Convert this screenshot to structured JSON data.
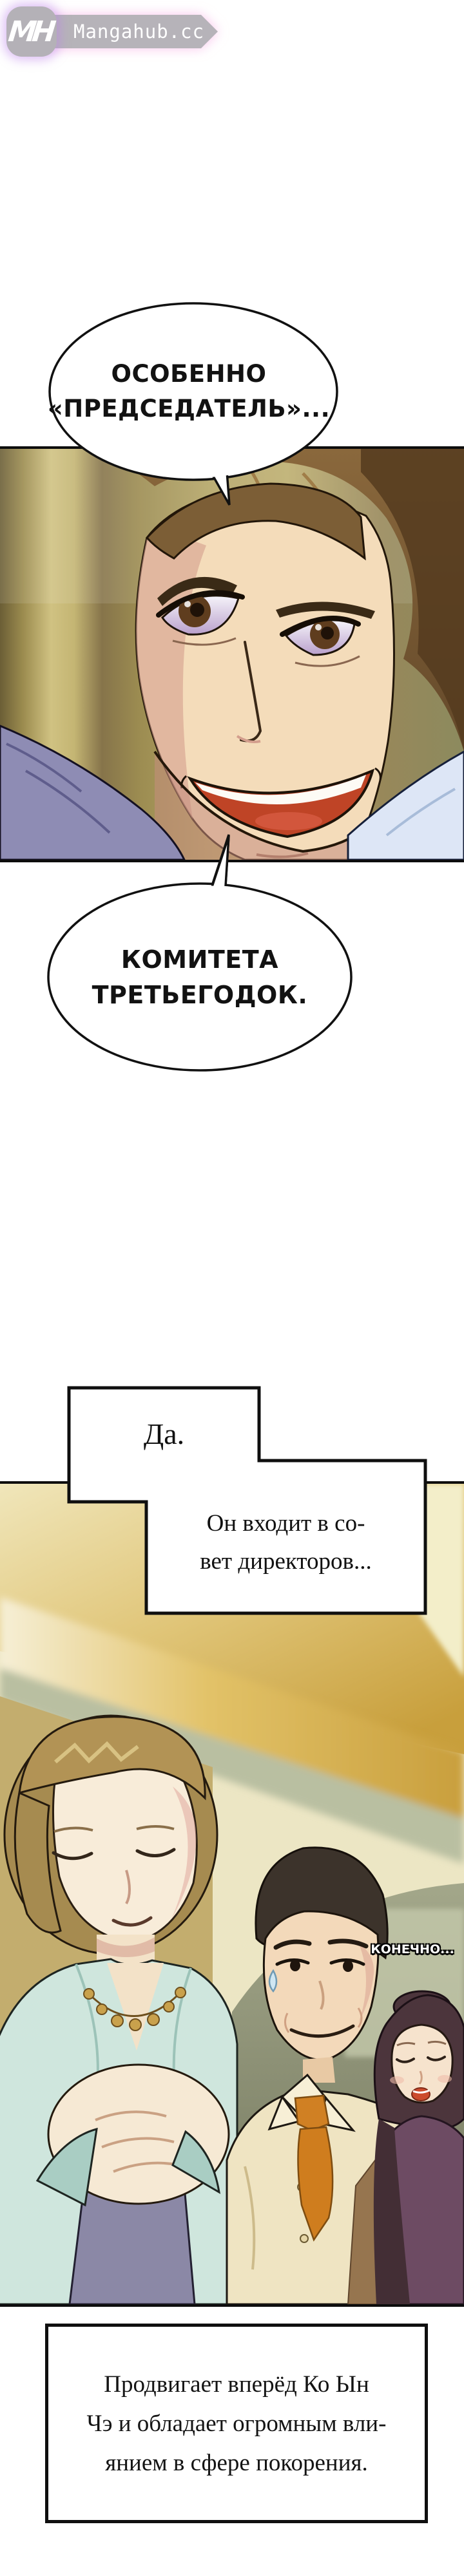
{
  "site": {
    "monogram": "MH",
    "name": "Mangahub.cc"
  },
  "speech": {
    "bubble1_line1": "ОСОБЕННО",
    "bubble1_line2": "«ПРЕДСЕДАТЕЛЬ»...",
    "bubble2_line1": "КОМИТЕТА",
    "bubble2_line2": "ТРЕТЬЕГОДОК.",
    "background_shout": "КОНЕЧНО..."
  },
  "narration": {
    "box1": "Да.",
    "box2_line1": "Он входит в со-",
    "box2_line2": "вет директоров...",
    "caption_line1": "Продвигает вперёд Ко Ын",
    "caption_line2": "Чэ и обладает огромным вли-",
    "caption_line3": "янием в сфере покорения."
  },
  "colors": {
    "logo_gray": "#b5b2b8",
    "logo_glow_purple": "#d9a6f0",
    "panel1_background_olive": "#b3a364",
    "man_shirt_periwinkle": "#9aa0d0",
    "panel2_ceiling_gold": "#cda74b",
    "panel2_wall_sage": "#8f937a",
    "woman_cardigan_mint": "#cfe6dd",
    "man2_tie_orange": "#cf7d1e"
  }
}
